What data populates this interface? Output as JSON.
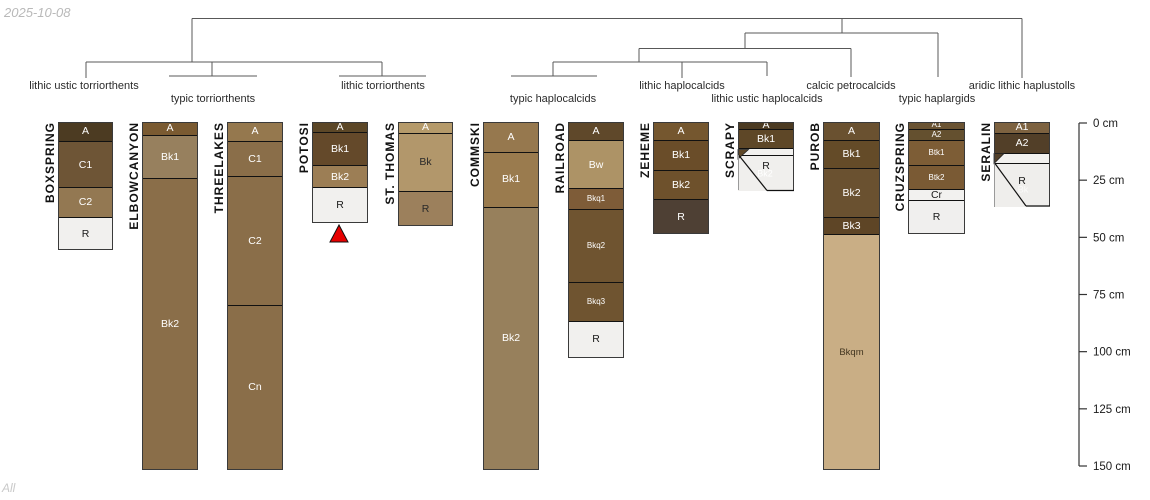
{
  "title_date": "2025-10-08",
  "footer": "All",
  "chart_data": {
    "type": "soil-profile-dendrogram",
    "depth_unit": "cm",
    "px_per_cm": 2.2867,
    "profiles_top_px": 122,
    "depth_axis": {
      "x": 1079,
      "top_px": 123,
      "tick_len": 8,
      "suffix": " cm",
      "ticks": [
        0,
        25,
        50,
        75,
        100,
        125,
        150
      ],
      "line_color": "#333333",
      "label_color": "#1a1a1a"
    },
    "taxa_labels": [
      {
        "text": "lithic ustic torriorthents",
        "x": 84,
        "row": 1
      },
      {
        "text": "typic torriorthents",
        "x": 213,
        "row": 2
      },
      {
        "text": "lithic torriorthents",
        "x": 383,
        "row": 1
      },
      {
        "text": "typic haplocalcids",
        "x": 553,
        "row": 2
      },
      {
        "text": "lithic haplocalcids",
        "x": 682,
        "row": 1
      },
      {
        "text": "lithic ustic haplocalcids",
        "x": 767,
        "row": 2
      },
      {
        "text": "calcic petrocalcids",
        "x": 851,
        "row": 1
      },
      {
        "text": "typic haplargids",
        "x": 937,
        "row": 2
      },
      {
        "text": "aridic lithic haplustolls",
        "x": 1022,
        "row": 1
      }
    ],
    "dendrogram": {
      "color": "#585858",
      "segments": [
        [
          192,
          18.5,
          1022,
          18.5
        ],
        [
          192,
          18.5,
          192,
          62
        ],
        [
          1022,
          18.5,
          1022,
          78
        ],
        [
          842,
          18.5,
          842,
          33
        ],
        [
          745,
          33,
          938,
          33
        ],
        [
          938,
          33,
          938,
          77
        ],
        [
          745,
          33,
          745,
          48.5
        ],
        [
          639,
          48.5,
          851,
          48.5
        ],
        [
          851,
          48.5,
          851,
          77
        ],
        [
          639,
          48.5,
          639,
          62
        ],
        [
          86,
          62,
          382,
          62
        ],
        [
          86,
          62,
          86,
          78
        ],
        [
          212,
          62,
          212,
          76
        ],
        [
          382,
          62,
          382,
          76
        ],
        [
          169,
          76,
          257,
          76
        ],
        [
          339,
          76,
          426,
          76
        ],
        [
          553,
          62,
          767,
          62
        ],
        [
          553,
          62,
          553,
          76
        ],
        [
          511,
          76,
          597,
          76
        ],
        [
          682,
          62,
          682,
          78
        ],
        [
          767,
          62,
          767,
          76
        ]
      ]
    },
    "profiles": [
      {
        "name": "BOXSPRING",
        "x": 58,
        "width": 55,
        "outline": true,
        "horizons": [
          {
            "label": "A",
            "top": 0,
            "bottom": 8.5,
            "color": "#4c3b22",
            "text": "#ffffff"
          },
          {
            "label": "C1",
            "top": 8.5,
            "bottom": 28.5,
            "color": "#6e5536",
            "text": "#ffffff"
          },
          {
            "label": "C2",
            "top": 28.5,
            "bottom": 41.5,
            "color": "#937852",
            "text": "#ffffff"
          },
          {
            "label": "R",
            "top": 41.5,
            "bottom": 56,
            "color": "#f1f0ee",
            "text": "#1a1a1a"
          }
        ]
      },
      {
        "name": "ELBOWCANYON",
        "x": 142,
        "width": 56,
        "outline": true,
        "horizons": [
          {
            "label": "A",
            "top": 0,
            "bottom": 5.5,
            "color": "#7a5a31",
            "text": "#ffffff"
          },
          {
            "label": "Bk1",
            "top": 5.5,
            "bottom": 24.5,
            "color": "#97805e",
            "text": "#ffffff"
          },
          {
            "label": "Bk2",
            "top": 24.5,
            "bottom": 152,
            "color": "#8a6e49",
            "text": "#ffffff"
          }
        ]
      },
      {
        "name": "THREELAKES",
        "x": 227,
        "width": 56,
        "outline": true,
        "horizons": [
          {
            "label": "A",
            "top": 0,
            "bottom": 8.5,
            "color": "#95784e",
            "text": "#ffffff"
          },
          {
            "label": "C1",
            "top": 8.5,
            "bottom": 23.5,
            "color": "#8a6e49",
            "text": "#ffffff"
          },
          {
            "label": "C2",
            "top": 23.5,
            "bottom": 80,
            "color": "#8a6e49",
            "text": "#ffffff"
          },
          {
            "label": "Cn",
            "top": 80,
            "bottom": 152,
            "color": "#8a6e49",
            "text": "#ffffff"
          }
        ]
      },
      {
        "name": "POTOSI",
        "x": 312,
        "width": 56,
        "outline": true,
        "horizons": [
          {
            "label": "A",
            "top": 0,
            "bottom": 4.5,
            "color": "#5c4727",
            "text": "#ffffff"
          },
          {
            "label": "Bk1",
            "top": 4.5,
            "bottom": 19,
            "color": "#64492a",
            "text": "#ffffff"
          },
          {
            "label": "Bk2",
            "top": 19,
            "bottom": 28.5,
            "color": "#9c7e55",
            "text": "#ffffff"
          },
          {
            "label": "R",
            "top": 28.5,
            "bottom": 44,
            "color": "#f1f0ee",
            "text": "#1a1a1a"
          }
        ]
      },
      {
        "name": "ST. THOMAS",
        "x": 398,
        "width": 55,
        "outline": true,
        "horizons": [
          {
            "label": "A",
            "top": 0,
            "bottom": 5,
            "color": "#b59a6a",
            "text": "#ffffff"
          },
          {
            "label": "Bk",
            "top": 5,
            "bottom": 30,
            "color": "#b2976b",
            "text": "#2a2a2a"
          },
          {
            "label": "R",
            "top": 30,
            "bottom": 45.5,
            "color": "#9c805c",
            "text": "#2a2a2a"
          }
        ]
      },
      {
        "name": "COMMSKI",
        "x": 483,
        "width": 56,
        "outline": true,
        "horizons": [
          {
            "label": "A",
            "top": 0,
            "bottom": 13,
            "color": "#96784e",
            "text": "#ffffff"
          },
          {
            "label": "Bk1",
            "top": 13,
            "bottom": 37,
            "color": "#9a7b4e",
            "text": "#ffffff"
          },
          {
            "label": "Bk2",
            "top": 37,
            "bottom": 152,
            "color": "#97805c",
            "text": "#ffffff"
          }
        ]
      },
      {
        "name": "RAILROAD",
        "x": 568,
        "width": 56,
        "outline": true,
        "horizons": [
          {
            "label": "A",
            "top": 0,
            "bottom": 8,
            "color": "#5f482a",
            "text": "#ffffff"
          },
          {
            "label": "Bw",
            "top": 8,
            "bottom": 29,
            "color": "#ad9366",
            "text": "#ffffff"
          },
          {
            "label": "Bkq1",
            "top": 29,
            "bottom": 38,
            "color": "#7e5c38",
            "text": "#ffffff",
            "size": 8
          },
          {
            "label": "Bkq2",
            "top": 38,
            "bottom": 70,
            "color": "#6f5430",
            "text": "#ffffff",
            "size": 8
          },
          {
            "label": "Bkq3",
            "top": 70,
            "bottom": 87,
            "color": "#6f5430",
            "text": "#ffffff",
            "size": 8
          },
          {
            "label": "R",
            "top": 87,
            "bottom": 103,
            "color": "#f1f0ee",
            "text": "#1a1a1a"
          }
        ]
      },
      {
        "name": "ZEHEME",
        "x": 653,
        "width": 56,
        "outline": true,
        "horizons": [
          {
            "label": "A",
            "top": 0,
            "bottom": 8,
            "color": "#75572f",
            "text": "#ffffff"
          },
          {
            "label": "Bk1",
            "top": 8,
            "bottom": 21,
            "color": "#6a4d29",
            "text": "#ffffff"
          },
          {
            "label": "Bk2",
            "top": 21,
            "bottom": 33.5,
            "color": "#6e512c",
            "text": "#ffffff"
          },
          {
            "label": "R",
            "top": 33.5,
            "bottom": 49,
            "color": "#4e4034",
            "text": "#ffffff"
          }
        ]
      },
      {
        "name": "SCRAPY",
        "x": 738,
        "width": 56,
        "outline": false,
        "horizons": [
          {
            "label": "A",
            "top": 0,
            "bottom": 3,
            "color": "#4c3b22",
            "text": "#ffffff"
          },
          {
            "label": "Bk1",
            "top": 3,
            "bottom": 11.5,
            "color": "#5e4727",
            "text": "#ffffff"
          },
          {
            "label": "",
            "top": 11.5,
            "bottom": 14.5,
            "color": "#f2f1ef",
            "text": "#ffffff"
          },
          {
            "label": "",
            "top": 14.5,
            "bottom": 30,
            "color": "#f0efed",
            "text": "#1a1a1a"
          }
        ]
      },
      {
        "name": "PUROB",
        "x": 823,
        "width": 57,
        "outline": true,
        "horizons": [
          {
            "label": "A",
            "top": 0,
            "bottom": 8,
            "color": "#6a5130",
            "text": "#ffffff"
          },
          {
            "label": "Bk1",
            "top": 8,
            "bottom": 20,
            "color": "#644b28",
            "text": "#ffffff"
          },
          {
            "label": "Bk2",
            "top": 20,
            "bottom": 41.5,
            "color": "#6a5130",
            "text": "#ffffff"
          },
          {
            "label": "Bk3",
            "top": 41.5,
            "bottom": 49,
            "color": "#5e4526",
            "text": "#ffffff"
          },
          {
            "label": "Bkqm",
            "top": 49,
            "bottom": 152,
            "color": "#c9ae85",
            "text": "#42351f",
            "size": 9.5
          }
        ]
      },
      {
        "name": "CRUZSPRING",
        "x": 908,
        "width": 57,
        "outline": true,
        "horizons": [
          {
            "label": "A1",
            "top": 0,
            "bottom": 3,
            "color": "#6b5433",
            "text": "#ffffff",
            "size": 8
          },
          {
            "label": "A2",
            "top": 3,
            "bottom": 8,
            "color": "#64502f",
            "text": "#ffffff",
            "size": 8
          },
          {
            "label": "Btk1",
            "top": 8,
            "bottom": 19,
            "color": "#7d5d36",
            "text": "#ffffff",
            "size": 8
          },
          {
            "label": "Btk2",
            "top": 19,
            "bottom": 29.5,
            "color": "#7a5a34",
            "text": "#ffffff",
            "size": 8
          },
          {
            "label": "Cr",
            "top": 29.5,
            "bottom": 34,
            "color": "#f2f1ef",
            "text": "#1a1a1a"
          },
          {
            "label": "R",
            "top": 34,
            "bottom": 49,
            "color": "#f0efee",
            "text": "#1a1a1a"
          }
        ]
      },
      {
        "name": "SERALIN",
        "x": 994,
        "width": 56,
        "outline": false,
        "horizons": [
          {
            "label": "A1",
            "top": 0,
            "bottom": 5,
            "color": "#7d6240",
            "text": "#ffffff"
          },
          {
            "label": "A2",
            "top": 5,
            "bottom": 13.5,
            "color": "#523f28",
            "text": "#ffffff"
          },
          {
            "label": "",
            "top": 13.5,
            "bottom": 18,
            "color": "#f2f1ef",
            "text": "#ffffff"
          },
          {
            "label": "",
            "top": 18,
            "bottom": 37,
            "color": "#efeeec",
            "text": "#1a1a1a"
          }
        ]
      }
    ],
    "annotations": {
      "shapes": [
        {
          "type": "polygon",
          "name": "red-triangle-marker",
          "points": "330,242 348,242 339,225",
          "fill": "#e60000",
          "stroke": "#111111",
          "sw": 1
        },
        {
          "type": "polygon",
          "name": "scrapy-wedge",
          "points": "738,149.5 748.5,149.5 738,159",
          "fill": "#5e4727",
          "stroke": "#222222",
          "sw": 0.8
        },
        {
          "type": "polygon",
          "name": "seralin-wedge",
          "points": "994,153.5 1004,153.5 994,163.5",
          "fill": "#523f28",
          "stroke": "#222222",
          "sw": 0.8
        },
        {
          "type": "line",
          "name": "scrapy-top-border",
          "x1": 738,
          "y1": 122.5,
          "x2": 794,
          "y2": 122.5,
          "stroke": "#3a3a3a",
          "sw": 1
        },
        {
          "type": "line",
          "name": "scrapy-right-border",
          "x1": 793.5,
          "y1": 122,
          "x2": 793.5,
          "y2": 190.5,
          "stroke": "#3a3a3a",
          "sw": 1
        },
        {
          "type": "line",
          "name": "scrapy-left-border-upper",
          "x1": 738.5,
          "y1": 122,
          "x2": 738.5,
          "y2": 155,
          "stroke": "#3a3a3a",
          "sw": 1
        },
        {
          "type": "line",
          "name": "scrapy-left-border-lower",
          "x1": 738.5,
          "y1": 155,
          "x2": 738.5,
          "y2": 190,
          "stroke": "#9a9a9a",
          "sw": 1
        },
        {
          "type": "line",
          "name": "scrapy-diagonal",
          "x1": 739,
          "y1": 155.5,
          "x2": 767,
          "y2": 190.5,
          "stroke": "#111111",
          "sw": 1.2
        },
        {
          "type": "line",
          "name": "scrapy-bottom-border",
          "x1": 767,
          "y1": 190.5,
          "x2": 794,
          "y2": 190.5,
          "stroke": "#111111",
          "sw": 1.2
        },
        {
          "type": "line",
          "name": "seralin-top-border",
          "x1": 994,
          "y1": 122.5,
          "x2": 1050,
          "y2": 122.5,
          "stroke": "#3a3a3a",
          "sw": 1
        },
        {
          "type": "line",
          "name": "seralin-right-border",
          "x1": 1049.5,
          "y1": 122,
          "x2": 1049.5,
          "y2": 206.5,
          "stroke": "#3a3a3a",
          "sw": 1
        },
        {
          "type": "line",
          "name": "seralin-left-border-upper",
          "x1": 994.5,
          "y1": 122,
          "x2": 994.5,
          "y2": 163.5,
          "stroke": "#3a3a3a",
          "sw": 1
        },
        {
          "type": "line",
          "name": "seralin-left-border-lower",
          "x1": 994.5,
          "y1": 163.5,
          "x2": 994.5,
          "y2": 207,
          "stroke": "#9a9a9a",
          "sw": 1
        },
        {
          "type": "line",
          "name": "seralin-diagonal",
          "x1": 995,
          "y1": 163.5,
          "x2": 1026,
          "y2": 206,
          "stroke": "#111111",
          "sw": 1.2
        },
        {
          "type": "line",
          "name": "seralin-bottom-border",
          "x1": 1026,
          "y1": 206,
          "x2": 1050,
          "y2": 206,
          "stroke": "#111111",
          "sw": 1.2
        }
      ],
      "texts": [
        {
          "name": "scrapy-r-label",
          "x": 766,
          "y": 166,
          "t": "R",
          "color": "#1a1a1a",
          "size": 10.5
        },
        {
          "name": "scrapy-bk2-label",
          "x": 765,
          "y": 174,
          "t": "Bk2",
          "color": "#ffffff",
          "size": 9
        },
        {
          "name": "seralin-r-label",
          "x": 1022,
          "y": 181,
          "t": "R",
          "color": "#1a1a1a",
          "size": 10.5
        },
        {
          "name": "seralin-bk-label",
          "x": 1023,
          "y": 190,
          "t": "Bk",
          "color": "#fbfbfa",
          "size": 9
        }
      ]
    }
  }
}
